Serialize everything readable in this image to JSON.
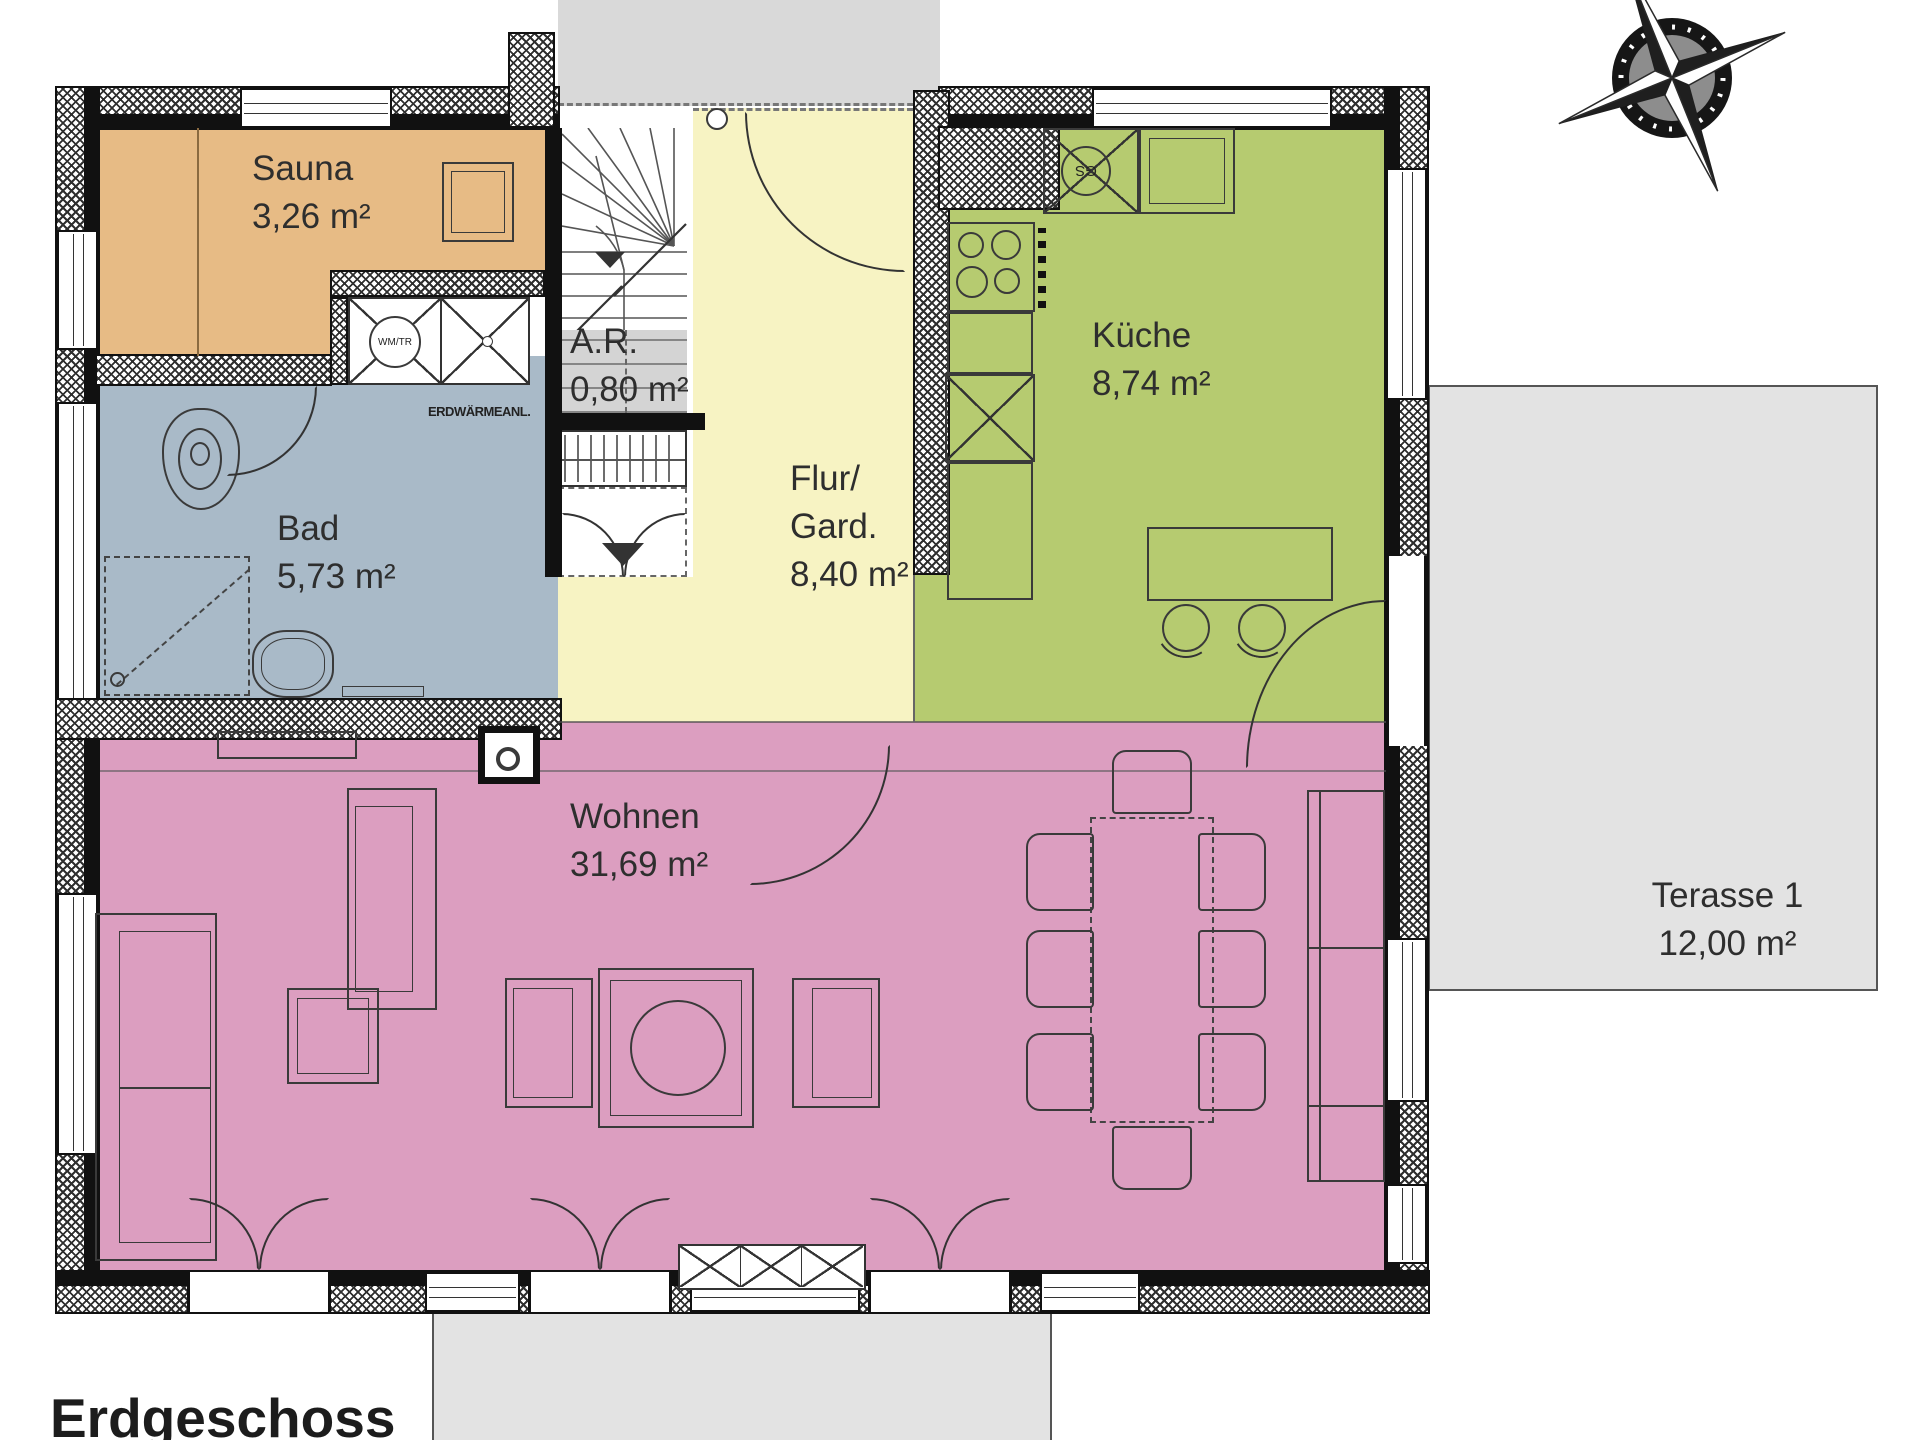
{
  "title": "Erdgeschoss",
  "rooms": {
    "sauna": {
      "label": "Sauna",
      "area": "3,26 m²"
    },
    "bad": {
      "label": "Bad",
      "area": "5,73 m²"
    },
    "ar": {
      "label": "A.R.",
      "area": "0,80 m²"
    },
    "flur": {
      "label": "Flur/\nGard.",
      "area": "8,40 m²"
    },
    "kueche": {
      "label": "Küche",
      "area": "8,74 m²"
    },
    "wohnen": {
      "label": "Wohnen",
      "area": "31,69 m²"
    },
    "terrasse1": {
      "label": "Terasse 1",
      "area": "12,00 m²"
    }
  },
  "labels": {
    "erdwaerme": "ERDWÄRMEANL.",
    "washer_dryer": "WM/TR",
    "dishwasher": "GS"
  },
  "colors": {
    "sauna": "#e7bb85",
    "bad": "#a9bac8",
    "flur": "#f7f3c3",
    "kueche": "#b6cb70",
    "wohnen": "#dc9ec0",
    "abstellraum": "#d4d4d4",
    "terrace": "#e3e3e3",
    "outside": "#d9d9d9",
    "wall": "#111111"
  }
}
